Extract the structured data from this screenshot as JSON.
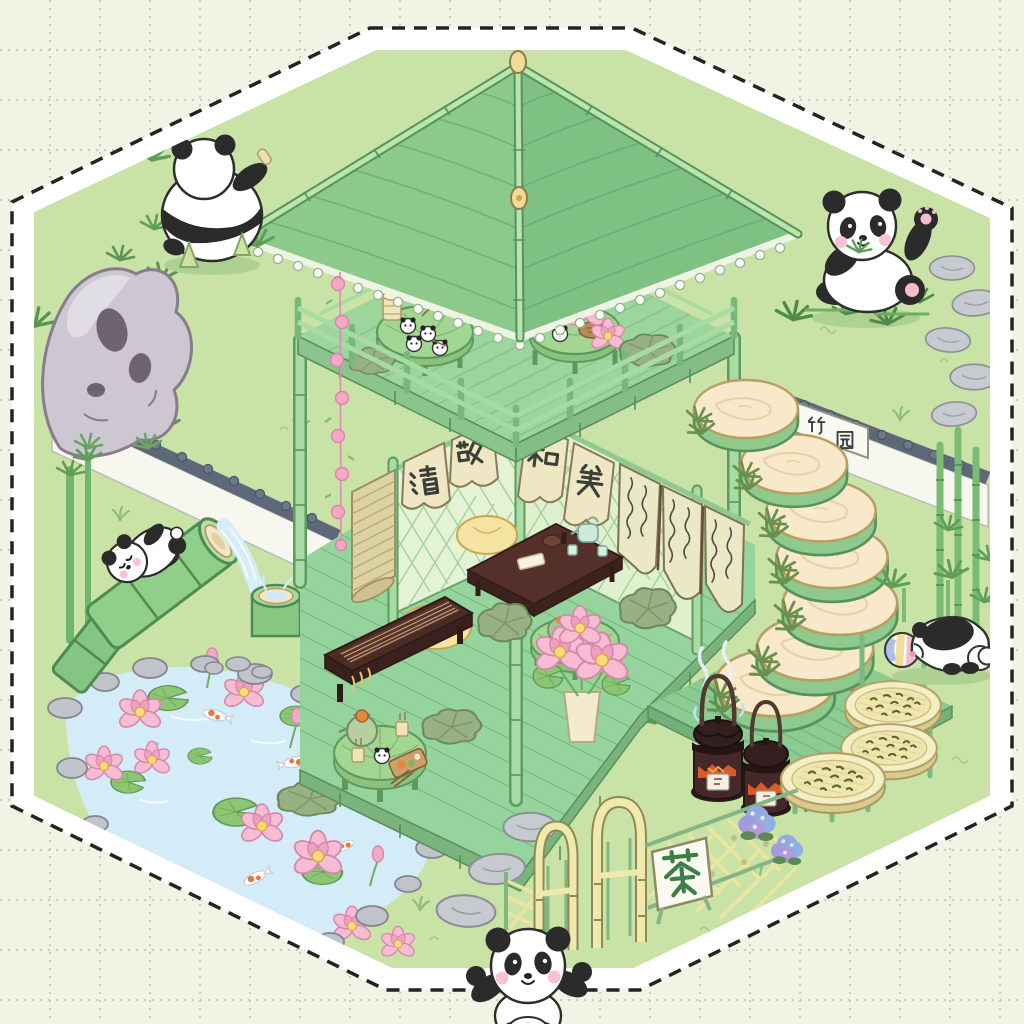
{
  "scene": {
    "title": "panda bamboo tea garden diorama",
    "frame": "hexagonal sticker with black dashed border and white margin on dotted-grid paper"
  },
  "signs": {
    "noren_left": {
      "char1": "清",
      "char2": "敬"
    },
    "noren_right": {
      "char1": "和",
      "char2": "美"
    },
    "wall_plaque": {
      "char1": "竹",
      "char2": "园"
    },
    "gate_sign": {
      "char": "茶"
    },
    "hanging_scroll": {
      "description": "three cloth strips of illegible cursive calligraphy"
    }
  },
  "inventory": {
    "pandas": [
      {
        "location": "top-left",
        "pose": "sitting seen from behind among bamboo shoots"
      },
      {
        "location": "top-right",
        "pose": "sitting, waving one paw, eating bamboo leaves"
      },
      {
        "location": "left",
        "pose": "cub clinging to giant bamboo water spout"
      },
      {
        "location": "right",
        "pose": "crouching face-down on striped ball"
      },
      {
        "location": "bottom-center",
        "pose": "walking toward viewer with both arms raised"
      }
    ],
    "panda_buns_on_tables": 6,
    "bamboo_slice_steps": 7,
    "kettles_on_charcoal_stoves": 2,
    "tea_drying_trays": 3,
    "balcony_tables": 2,
    "ground_tables": 2,
    "gate_doors": 2
  },
  "colors": {
    "paper": "#f1f3e4",
    "grid_dots": "#c4d2b4",
    "dash_border": "#232323",
    "lawn": "#c9e3a6",
    "roof_tile": "#8cc98a",
    "bamboo_light": "#a8dca4",
    "deck_green": "#95d49c",
    "water_blue": "#d3ecf8",
    "lotus_pink": "#f5bcd2",
    "cushion_yellow": "#f4e3a2",
    "wood_dark": "#4a2b26",
    "stone_gray": "#c7cacf",
    "tile_coping": "#5d6878",
    "gate_cream": "#f0e9ae",
    "tea_disc_cream": "#f7e9c9",
    "hydrangea_blue": "#96a8e0"
  }
}
